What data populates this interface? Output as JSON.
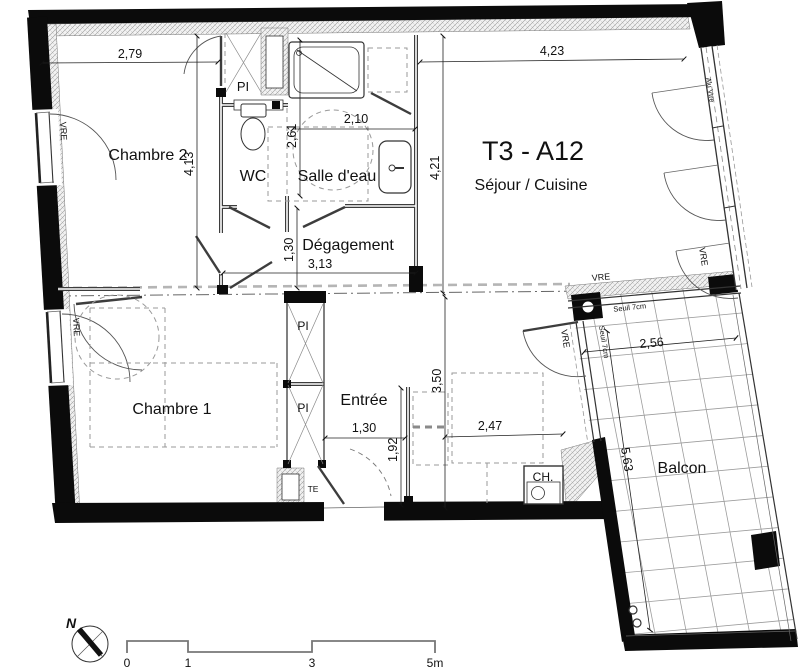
{
  "plan": {
    "title": "T3 - A12",
    "subtitle": "Séjour / Cuisine",
    "rooms": {
      "chambre2": "Chambre 2",
      "wc": "WC",
      "salle_eau": "Salle d'eau",
      "degagement": "Dégagement",
      "chambre1": "Chambre 1",
      "entree": "Entrée",
      "balcon": "Balcon"
    },
    "fixtures": {
      "pi": "PI",
      "te": "TE",
      "ch": "CH."
    },
    "openings": {
      "vre": "VRE",
      "alu_vtre": "Alu Vtre",
      "seuil": "Seuil 7cm"
    },
    "dimensions": {
      "chambre2_width": "2,79",
      "sejour_width": "4,23",
      "chambre2_depth": "4,13",
      "salle_eau_depth": "2,61",
      "salle_eau_width": "2,10",
      "sejour_depth": "4,21",
      "degagement_width": "1,30",
      "degagement_length": "3,13",
      "cuisine_depth": "3,50",
      "entree_width": "1,30",
      "entree_depth": "1,92",
      "cuisine_width": "2,47",
      "balcon_width": "2,56",
      "balcon_length": "5,63"
    },
    "scale_bar": {
      "t0": "0",
      "t1": "1",
      "t3": "3",
      "t5": "5m"
    },
    "north_label": "N"
  }
}
